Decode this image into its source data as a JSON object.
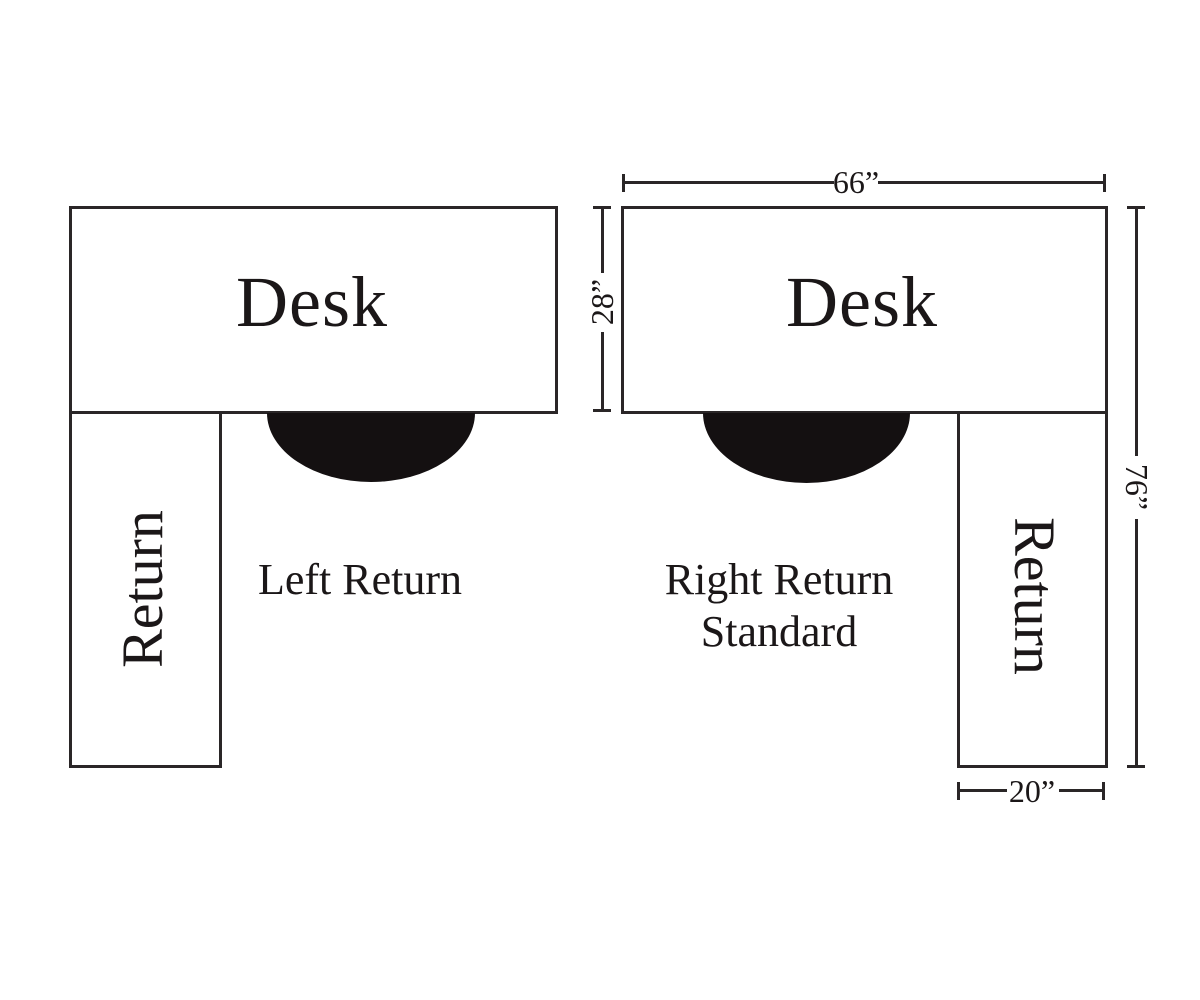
{
  "colors": {
    "background": "#ffffff",
    "line": "#2a2627",
    "text": "#1b1718",
    "chair_fill": "#141011"
  },
  "left_diagram": {
    "desk_label": "Desk",
    "return_label": "Return",
    "caption": "Left Return"
  },
  "right_diagram": {
    "desk_label": "Desk",
    "return_label": "Return",
    "caption_line1": "Right Return",
    "caption_line2": "Standard",
    "dimensions": {
      "top_width": "66”",
      "desk_depth": "28”",
      "overall_depth": "76”",
      "return_width": "20”"
    }
  }
}
